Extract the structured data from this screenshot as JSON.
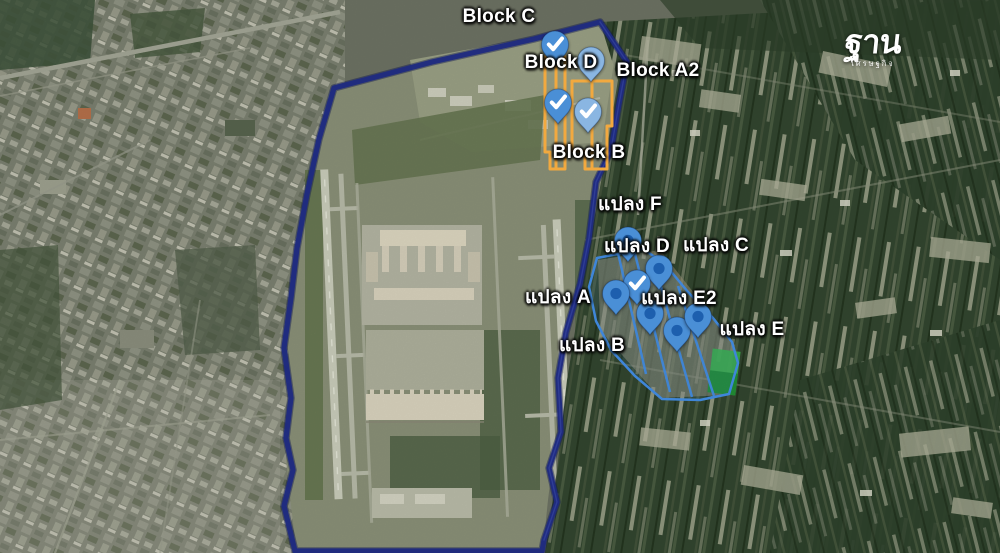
{
  "map": {
    "logo": {
      "title": "ฐาน",
      "subtitle": "เศรษฐกิจ"
    },
    "block_labels": [
      {
        "id": "block-c",
        "text": "Block C",
        "x": 499,
        "y": 17
      },
      {
        "id": "block-d",
        "text": "Block D",
        "x": 561,
        "y": 63
      },
      {
        "id": "block-a2",
        "text": "Block A2",
        "x": 658,
        "y": 71
      },
      {
        "id": "block-b",
        "text": "Block B",
        "x": 589,
        "y": 153
      }
    ],
    "plot_labels": [
      {
        "id": "plot-f",
        "text": "แปลง F",
        "x": 630,
        "y": 204
      },
      {
        "id": "plot-d",
        "text": "แปลง D",
        "x": 637,
        "y": 246
      },
      {
        "id": "plot-c",
        "text": "แปลง C",
        "x": 716,
        "y": 245
      },
      {
        "id": "plot-a",
        "text": "แปลง A",
        "x": 558,
        "y": 297
      },
      {
        "id": "plot-e2",
        "text": "แปลง E2",
        "x": 679,
        "y": 298
      },
      {
        "id": "plot-b",
        "text": "แปลง B",
        "x": 592,
        "y": 345
      },
      {
        "id": "plot-e",
        "text": "แปลง E",
        "x": 752,
        "y": 329
      }
    ],
    "pins": [
      {
        "x": 555,
        "y": 66,
        "type": "check",
        "tone": "medium"
      },
      {
        "x": 591,
        "y": 82,
        "type": "dot",
        "tone": "light"
      },
      {
        "x": 558,
        "y": 124,
        "type": "check",
        "tone": "medium"
      },
      {
        "x": 588,
        "y": 133,
        "type": "check",
        "tone": "light"
      },
      {
        "x": 628,
        "y": 262,
        "type": "dot",
        "tone": "medium"
      },
      {
        "x": 659,
        "y": 290,
        "type": "dot",
        "tone": "medium"
      },
      {
        "x": 637,
        "y": 305,
        "type": "check",
        "tone": "medium"
      },
      {
        "x": 616,
        "y": 315,
        "type": "dot",
        "tone": "medium"
      },
      {
        "x": 650,
        "y": 335,
        "type": "dot",
        "tone": "medium"
      },
      {
        "x": 677,
        "y": 352,
        "type": "dot",
        "tone": "medium"
      },
      {
        "x": 698,
        "y": 338,
        "type": "dot",
        "tone": "medium"
      }
    ],
    "colors": {
      "boundary": "#1f2b80",
      "block_outline": "#f2a93f",
      "parcel_outline": "#3f86d9",
      "pin": "#4a8fd6",
      "pin_light": "#8ab6e2",
      "pin_inner": "#1d5fae",
      "label_text": "#ffffff",
      "highlight_green": "#3bb54a"
    }
  }
}
